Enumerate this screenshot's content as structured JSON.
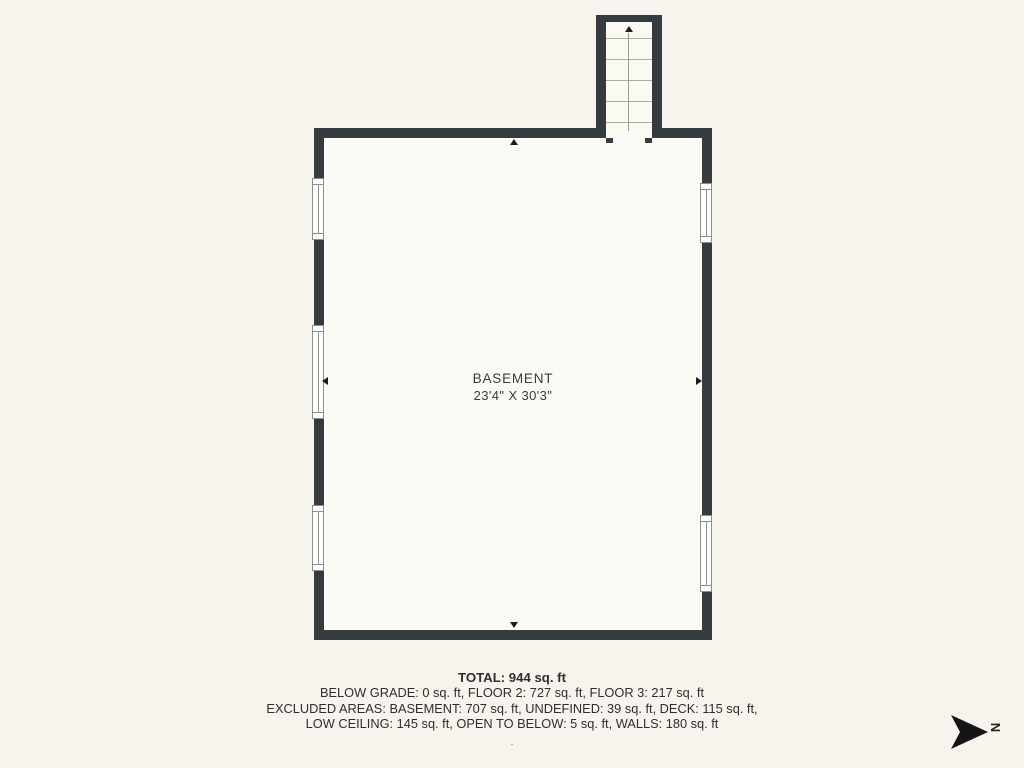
{
  "plan": {
    "room": {
      "label": "BASEMENT",
      "dimensions": "23'4\" X 30'3\""
    },
    "colors": {
      "background": "#f6f4ec",
      "wall": "#363b40",
      "interior": "#fbfaf5",
      "window_line": "#8f8f8a"
    }
  },
  "summary": {
    "total": "TOTAL: 944 sq. ft",
    "line1": "BELOW GRADE: 0 sq. ft, FLOOR 2: 727 sq. ft, FLOOR 3: 217 sq. ft",
    "line2": "EXCLUDED AREAS: BASEMENT: 707 sq. ft, UNDEFINED: 39 sq. ft, DECK: 115 sq. ft,",
    "line3": "LOW CEILING: 145 sq. ft, OPEN TO BELOW: 5 sq. ft, WALLS: 180 sq. ft",
    "footnote": "."
  },
  "compass": {
    "letter": "N"
  }
}
